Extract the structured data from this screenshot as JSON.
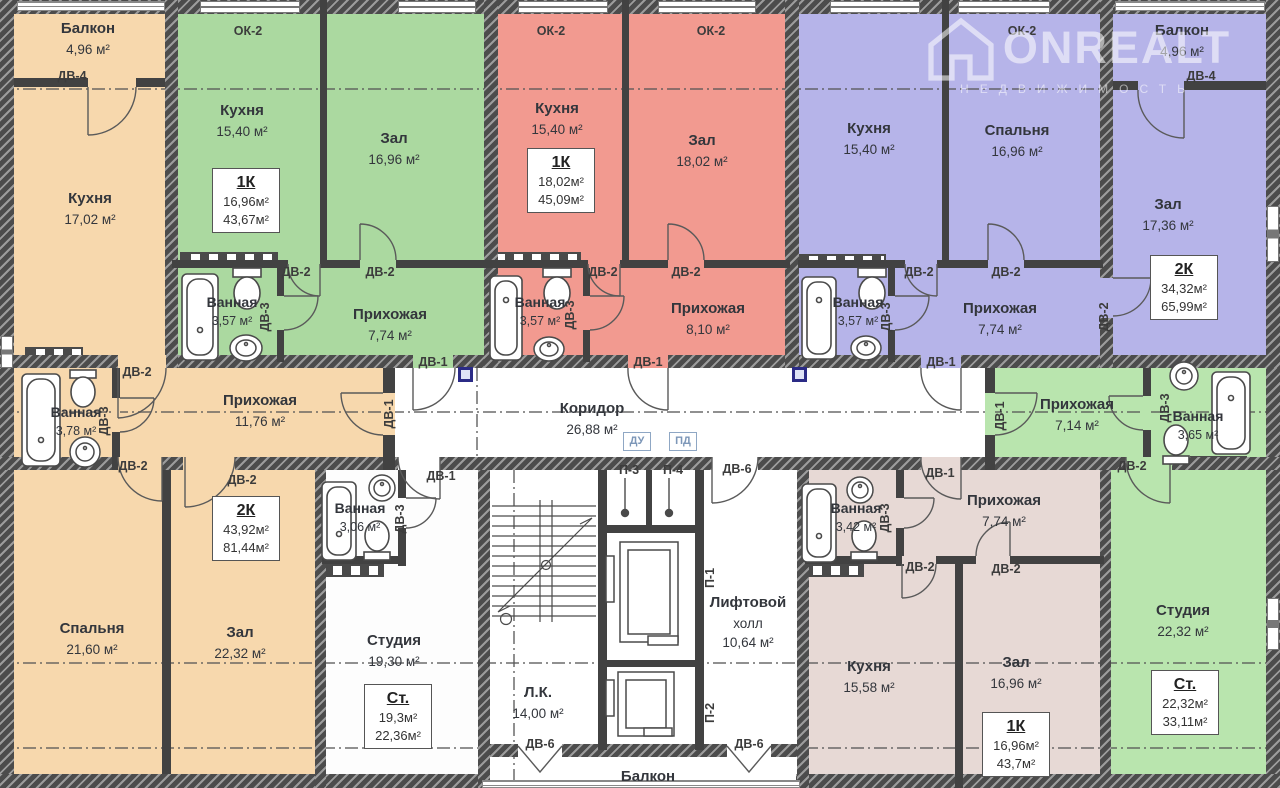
{
  "watermark": {
    "brand": "ONREALT",
    "subtitle": "НЕДВИЖИМОСТЬ"
  },
  "tags": {
    "dv1": "ДВ-1",
    "dv2": "ДВ-2",
    "dv3": "ДВ-3",
    "dv4": "ДВ-4",
    "dv6": "ДВ-6",
    "ok2": "ОК-2",
    "du": "ДУ",
    "pd": "ПД",
    "p1": "П-1",
    "p2": "П-2",
    "p3": "П-3",
    "p4": "П-4"
  },
  "apartments": {
    "left2k": {
      "badge": {
        "type": "2К",
        "area_living": "43,92м²",
        "area_total": "81,44м²"
      },
      "balcony": {
        "name": "Балкон",
        "area": "4,96 м²"
      },
      "kitchen": {
        "name": "Кухня",
        "area": "17,02 м²"
      },
      "bath": {
        "name": "Ванная",
        "area": "3,78 м²"
      },
      "hall": {
        "name": "Прихожая",
        "area": "11,76 м²"
      },
      "bedroom": {
        "name": "Спальня",
        "area": "21,60 м²"
      },
      "living": {
        "name": "Зал",
        "area": "22,32 м²"
      }
    },
    "green1k": {
      "badge": {
        "type": "1К",
        "area_living": "16,96м²",
        "area_total": "43,67м²"
      },
      "kitchen": {
        "name": "Кухня",
        "area": "15,40 м²"
      },
      "living": {
        "name": "Зал",
        "area": "16,96 м²"
      },
      "bath": {
        "name": "Ванная",
        "area": "3,57 м²"
      },
      "hall": {
        "name": "Прихожая",
        "area": "7,74 м²"
      }
    },
    "red1k": {
      "badge": {
        "type": "1К",
        "area_living": "18,02м²",
        "area_total": "45,09м²"
      },
      "kitchen": {
        "name": "Кухня",
        "area": "15,40 м²"
      },
      "living": {
        "name": "Зал",
        "area": "18,02 м²"
      },
      "bath": {
        "name": "Ванная",
        "area": "3,57 м²"
      },
      "hall": {
        "name": "Прихожая",
        "area": "8,10 м²"
      }
    },
    "purple2k": {
      "badge": {
        "type": "2К",
        "area_living": "34,32м²",
        "area_total": "65,99м²"
      },
      "kitchen": {
        "name": "Кухня",
        "area": "15,40 м²"
      },
      "bedroom": {
        "name": "Спальня",
        "area": "16,96 м²"
      },
      "balcony": {
        "name": "Балкон",
        "area": "4,96 м²"
      },
      "living": {
        "name": "Зал",
        "area": "17,36 м²"
      },
      "bath": {
        "name": "Ванная",
        "area": "3,57 м²"
      },
      "hall": {
        "name": "Прихожая",
        "area": "7,74 м²"
      }
    },
    "studio_mid": {
      "badge": {
        "type": "Ст.",
        "area_living": "19,3м²",
        "area_total": "22,36м²"
      },
      "bath": {
        "name": "Ванная",
        "area": "3,06 м²"
      },
      "room": {
        "name": "Студия",
        "area": "19,30 м²"
      }
    },
    "brown1k": {
      "badge": {
        "type": "1К",
        "area_living": "16,96м²",
        "area_total": "43,7м²"
      },
      "bath": {
        "name": "Ванная",
        "area": "3,42 м²"
      },
      "hall": {
        "name": "Прихожая",
        "area": "7,74 м²"
      },
      "kitchen": {
        "name": "Кухня",
        "area": "15,58 м²"
      },
      "living": {
        "name": "Зал",
        "area": "16,96 м²"
      }
    },
    "studio_right": {
      "badge": {
        "type": "Ст.",
        "area_living": "22,32м²",
        "area_total": "33,11м²"
      },
      "hall": {
        "name": "Прихожая",
        "area": "7,14 м²"
      },
      "bath": {
        "name": "Ванная",
        "area": "3,65 м²"
      },
      "room": {
        "name": "Студия",
        "area": "22,32 м²"
      }
    }
  },
  "common": {
    "corridor": {
      "name": "Коридор",
      "area": "26,88 м²"
    },
    "stairs": {
      "name": "Л.К.",
      "area": "14,00 м²"
    },
    "lift_hall": {
      "name_line1": "Лифтовой",
      "name_line2": "холл",
      "area": "10,64 м²"
    },
    "balcony_bottom": {
      "name": "Балкон"
    }
  },
  "colors": {
    "orange": "#f7d8ad",
    "green": "#abd9a0",
    "red": "#f29a90",
    "purple": "#b6b4e9",
    "brown": "#e7d9d5",
    "light_green": "#b9e5ae",
    "wall": "#424242",
    "marker_blue": "#2b2b86"
  }
}
